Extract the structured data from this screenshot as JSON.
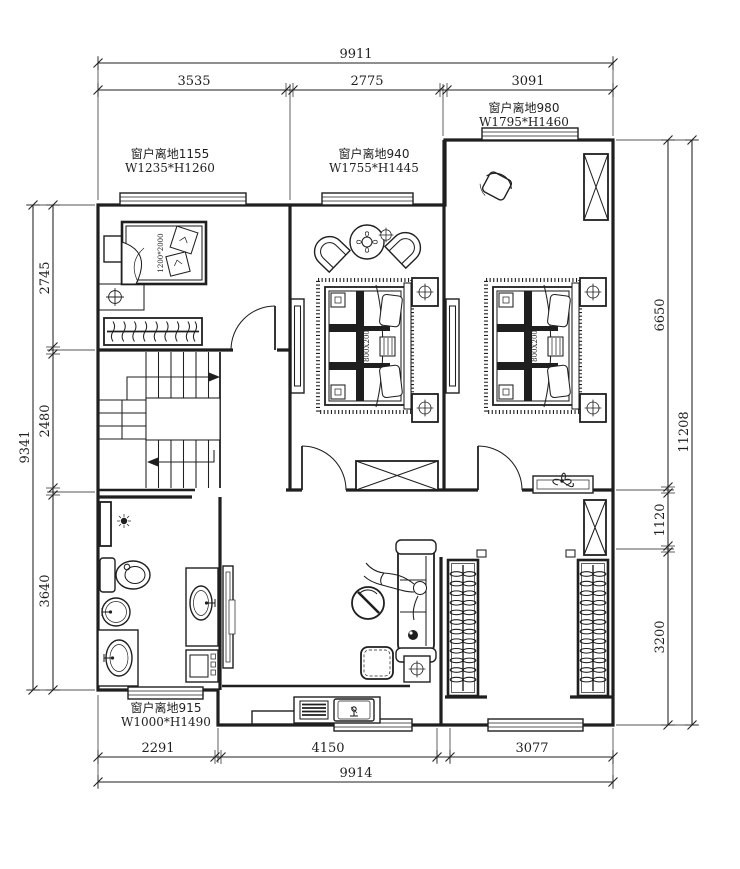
{
  "title": "second-floor-plan",
  "colors": {
    "line": "#1f1f1f",
    "background": "#ffffff"
  },
  "dims": {
    "top": {
      "overall": "9911",
      "segments": [
        "3535",
        "2775",
        "3091"
      ]
    },
    "left": {
      "overall": "9341",
      "segments": [
        "2745",
        "2480",
        "3640"
      ]
    },
    "right": {
      "overall": "11208",
      "segments": [
        "6650",
        "1120",
        "3200"
      ]
    },
    "bottom": {
      "overall": "9914",
      "segments": [
        "2291",
        "4150",
        "3077"
      ]
    }
  },
  "windows": [
    {
      "line1": "窗户离地1155",
      "line2": "W1235*H1260"
    },
    {
      "line1": "窗户离地940",
      "line2": "W1755*H1445"
    },
    {
      "line1": "窗户离地980",
      "line2": "W1795*H1460"
    },
    {
      "line1": "窗户离地915",
      "line2": "W1000*H1490"
    }
  ],
  "beds": {
    "small": "1200*2000",
    "master": "1800X2000",
    "second": "1800X2000"
  }
}
